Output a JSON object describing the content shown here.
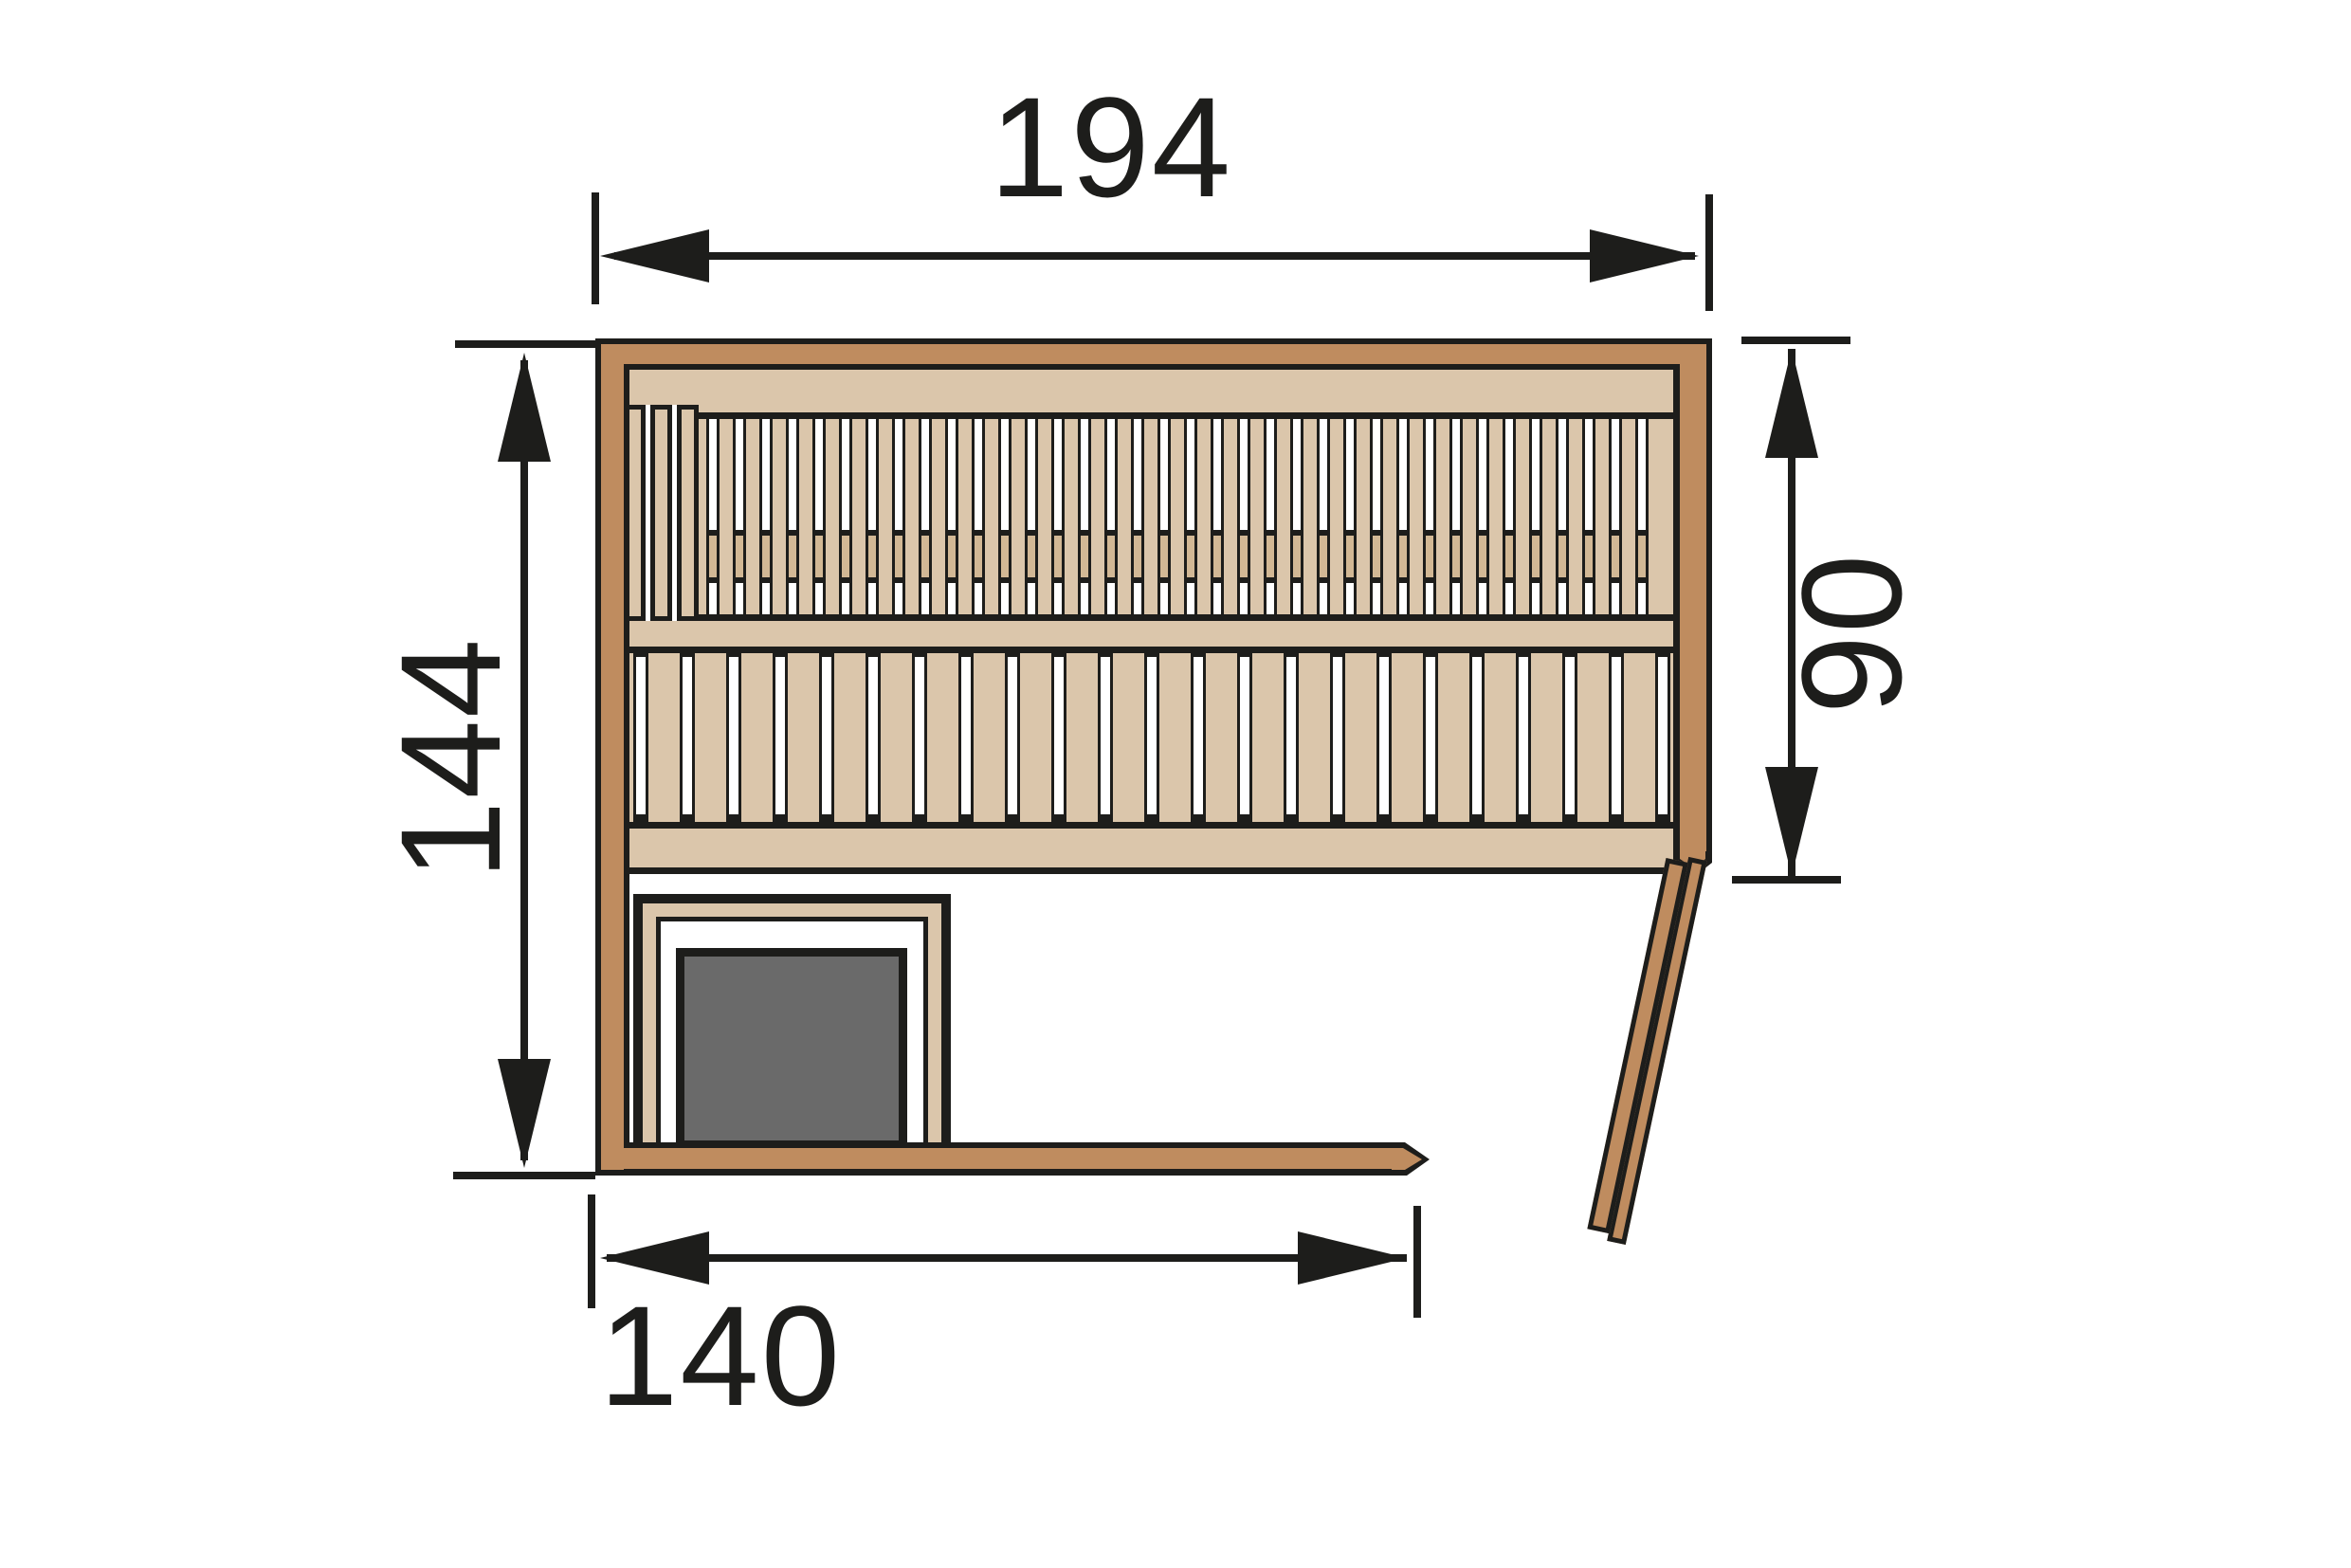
{
  "diagram": {
    "title": "sauna-floor-plan",
    "dimensions": {
      "outer_width_top": {
        "label": "194"
      },
      "outer_depth_left": {
        "label": "144"
      },
      "bench_depth_right": {
        "label": "90"
      },
      "front_wall_bottom": {
        "label": "140"
      }
    },
    "colors": {
      "ink": "#1d1d1b",
      "wall_wood": "#bf8c5f",
      "bench_wood": "#dbc6ab",
      "slot_support": "#d2b895",
      "heater": "#6a6a6a",
      "background": "#ffffff"
    },
    "elements": [
      "top-wall",
      "left-wall",
      "right-wall",
      "bottom-wall",
      "upper-bench",
      "lower-bench",
      "backrest-planks",
      "heater",
      "heater-guard",
      "door-open"
    ]
  }
}
